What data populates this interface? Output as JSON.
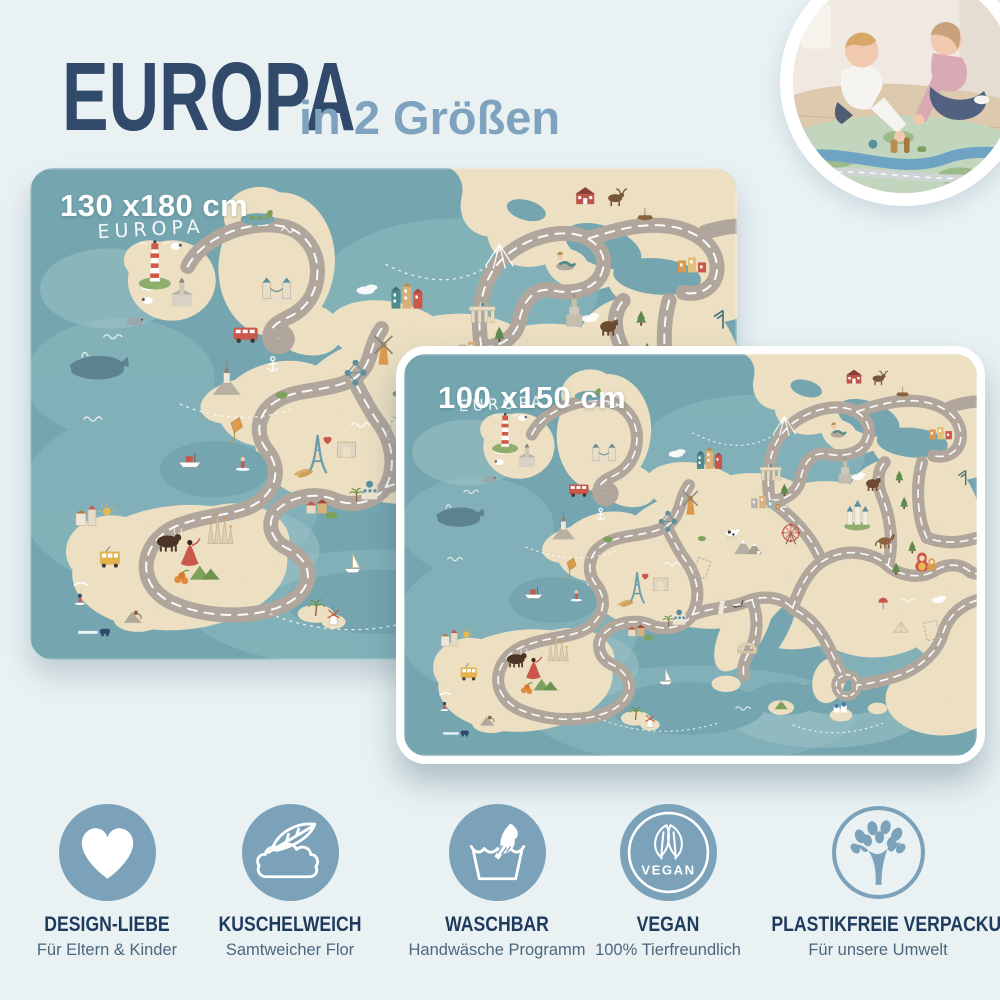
{
  "header": {
    "title": "EUROPA",
    "subtitle": "in 2 Größen"
  },
  "mats": [
    {
      "name": "play-mat-large",
      "size_label": "130 x180 cm"
    },
    {
      "name": "play-mat-small",
      "size_label": "100 x150 cm"
    }
  ],
  "map": {
    "script_label": "EUROPA"
  },
  "features": [
    {
      "icon": "heart-icon",
      "title": "DESIGN-LIEBE",
      "subtitle": "Für Eltern & Kinder"
    },
    {
      "icon": "feather-cloud-icon",
      "title": "KUSCHELWEICH",
      "subtitle": "Samtweicher Flor"
    },
    {
      "icon": "handwash-icon",
      "title": "WASCHBAR",
      "subtitle": "Handwäsche Programm"
    },
    {
      "icon": "vegan-badge-icon",
      "title": "VEGAN",
      "subtitle": "100% Tierfreundlich",
      "badge": "VEGAN"
    },
    {
      "icon": "tree-icon",
      "title": "PLASTIKFREIE VERPACKUNG",
      "subtitle": "Für unsere Umwelt"
    }
  ],
  "colors": {
    "background": "#e9f1f3",
    "title_navy": "#31496b",
    "title_lightblue": "#7fa3bf",
    "icon_blue": "#7ca2ba",
    "mat_sea": "#75a6b0",
    "mat_land": "#ecdfc2",
    "mat_road": "#b0a69c"
  }
}
